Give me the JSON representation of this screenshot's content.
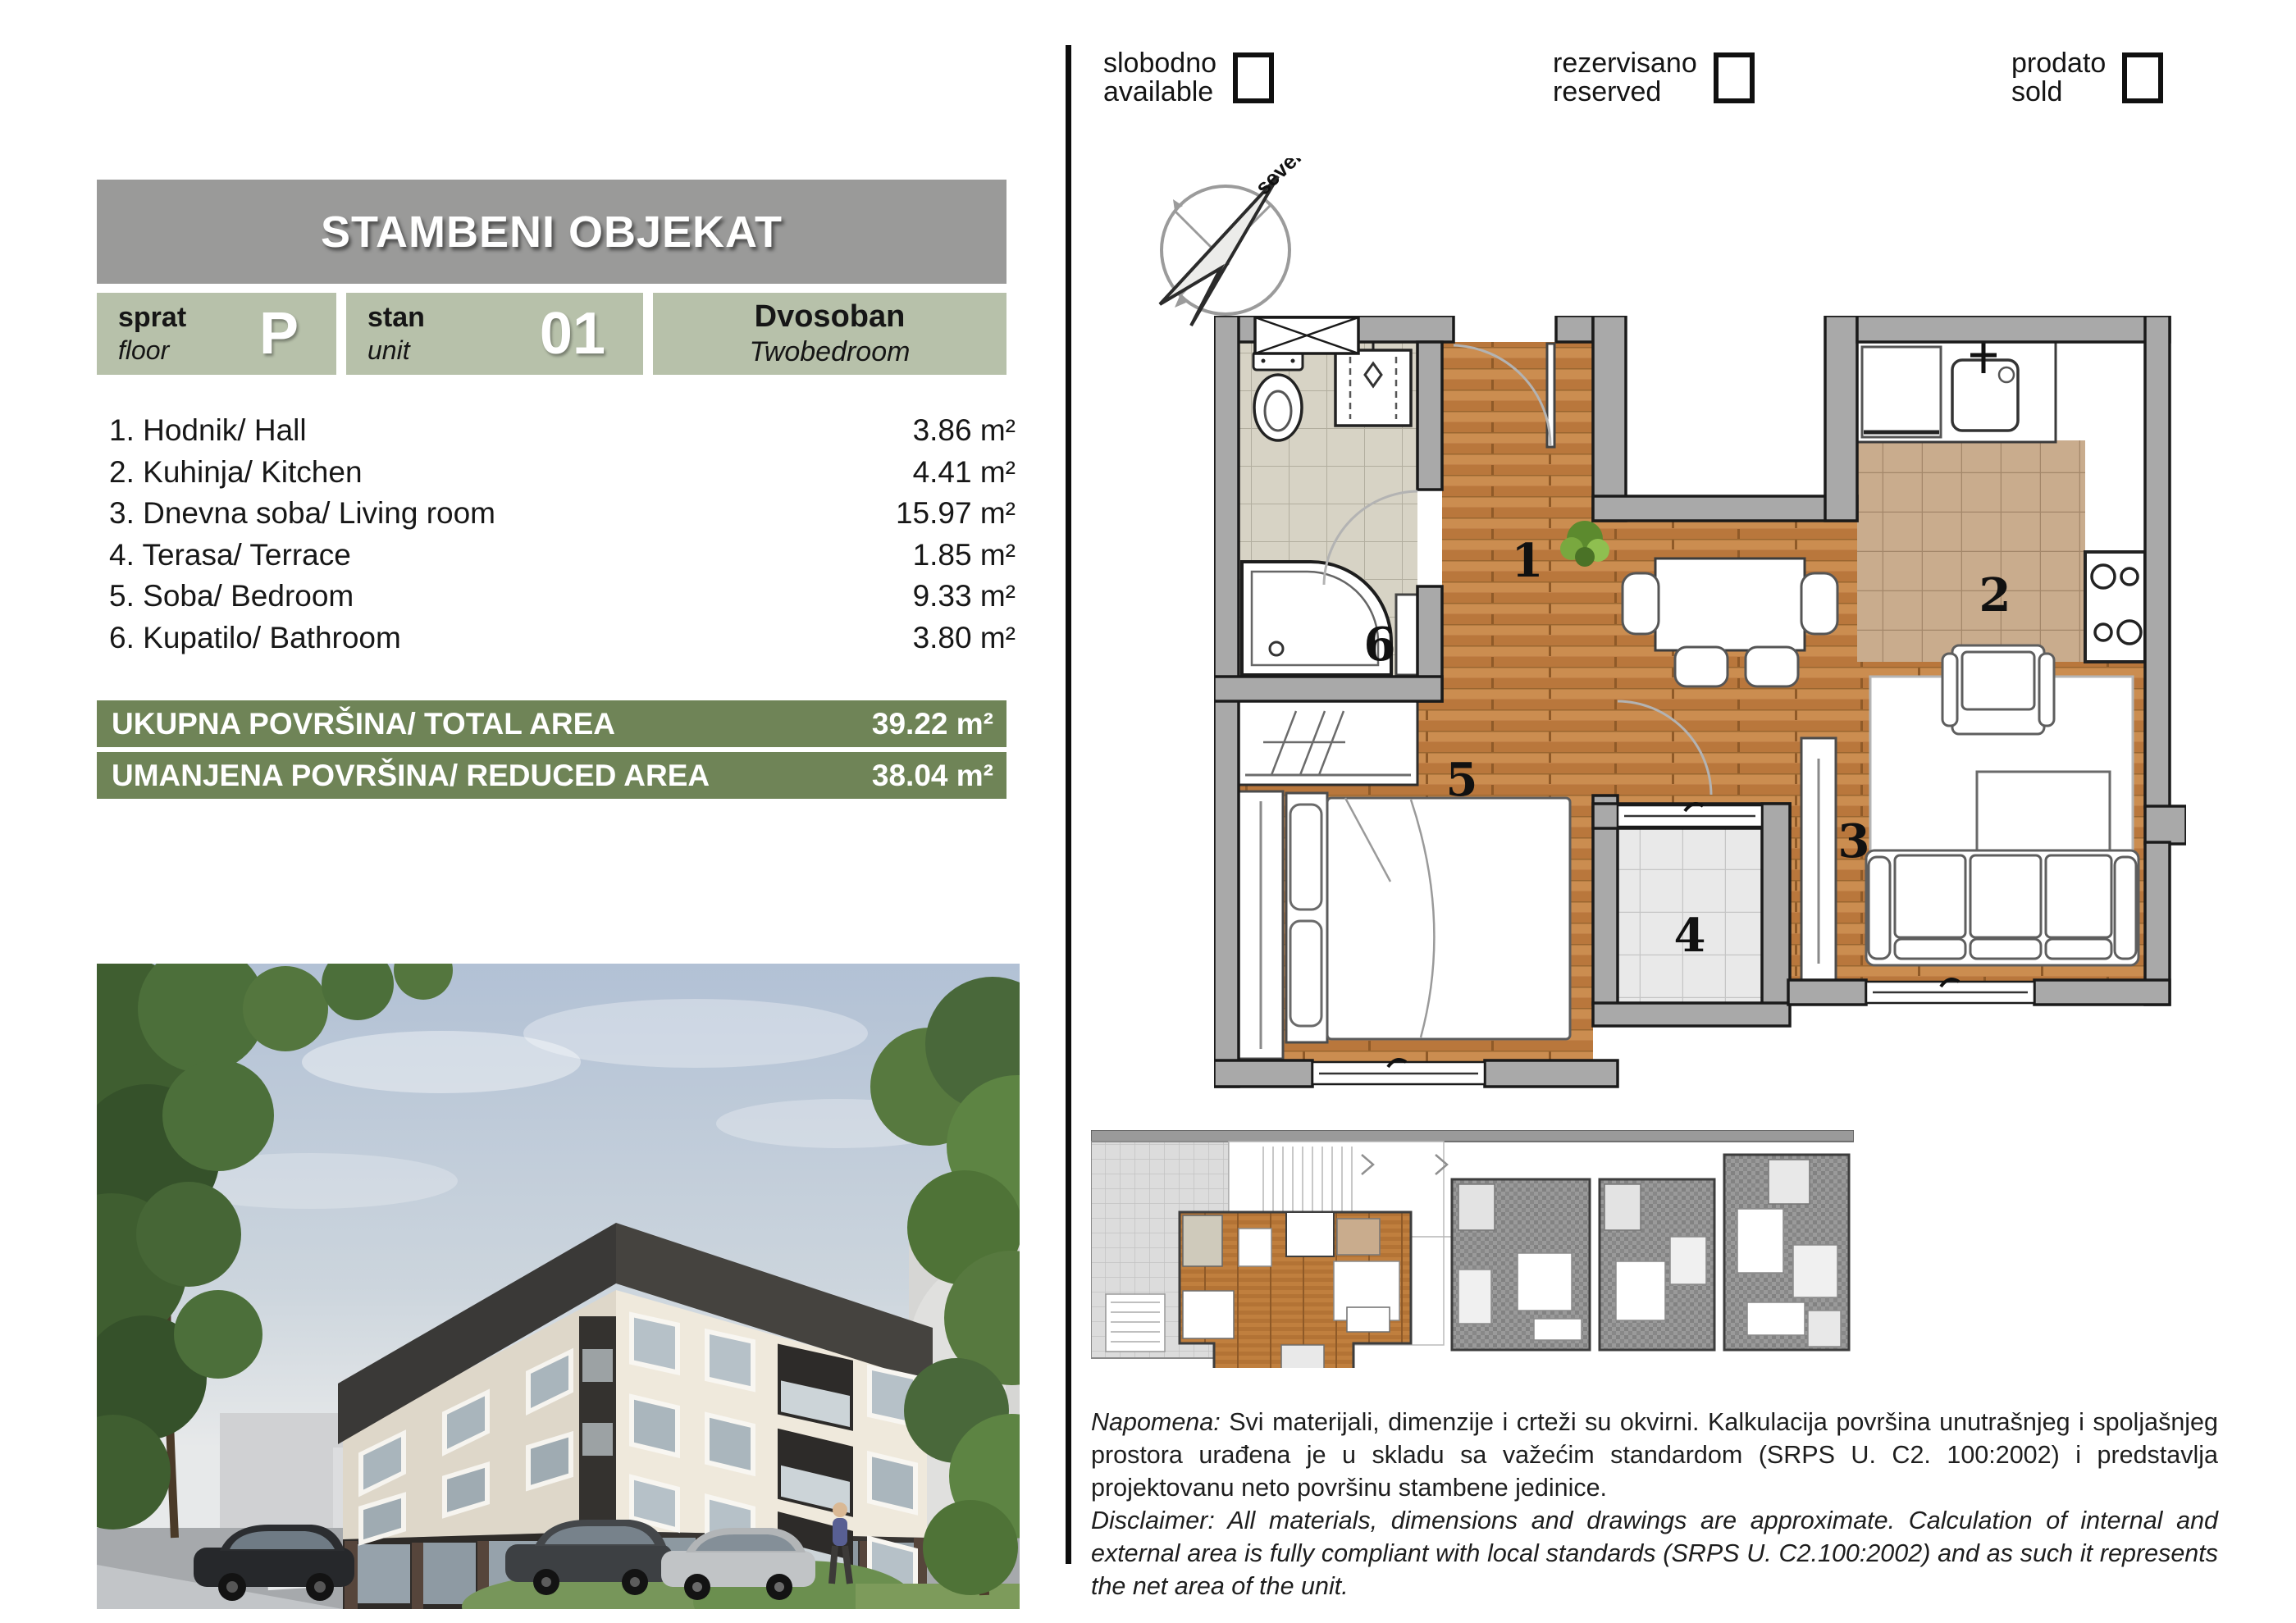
{
  "header": {
    "title": "STAMBENI OBJEKAT"
  },
  "unit_info": {
    "floor_label_sr": "sprat",
    "floor_label_en": "floor",
    "floor_value": "P",
    "unit_label_sr": "stan",
    "unit_label_en": "unit",
    "unit_value": "01",
    "type_sr": "Dvosoban",
    "type_en": "Twobedroom"
  },
  "rooms": [
    {
      "label": "1. Hodnik/ Hall",
      "area": "3.86 m²"
    },
    {
      "label": "2. Kuhinja/ Kitchen",
      "area": "4.41 m²"
    },
    {
      "label": "3. Dnevna soba/ Living room",
      "area": "15.97 m²"
    },
    {
      "label": "4. Terasa/ Terrace",
      "area": "1.85 m²"
    },
    {
      "label": "5. Soba/ Bedroom",
      "area": "9.33 m²"
    },
    {
      "label": "6. Kupatilo/ Bathroom",
      "area": "3.80 m²"
    }
  ],
  "totals": {
    "total_label": "UKUPNA POVRŠINA/ TOTAL AREA",
    "total_value": "39.22 m²",
    "reduced_label": "UMANJENA POVRŠINA/ REDUCED AREA",
    "reduced_value": "38.04 m²"
  },
  "legend": [
    {
      "sr": "slobodno",
      "en": "available"
    },
    {
      "sr": "rezervisano",
      "en": "reserved"
    },
    {
      "sr": "prodato",
      "en": "sold"
    }
  ],
  "compass": {
    "north_label": "sever"
  },
  "plan": {
    "labels": {
      "hall": "1",
      "kitchen": "2",
      "living": "3",
      "terrace": "4",
      "bedroom": "5",
      "bathroom": "6"
    }
  },
  "disclaimer": {
    "sr_prefix": "Napomena:",
    "sr_text": " Svi materijali, dimenzije i crteži su okvirni. Kalkulacija površina unutrašnjeg i spoljašnjeg prostora urađena je u skladu sa važećim standardom (SRPS U. C2. 100:2002) i predstavlja projektovanu neto površinu stambene jedinice.",
    "en_prefix": "Disclaimer:",
    "en_text": " All materials, dimensions and drawings are approximate. Calculation of internal and external area is fully compliant with local standards (SRPS U. C2.100:2002) and as such it represents the net area of the unit."
  },
  "colors": {
    "header_gray": "#9a9a99",
    "box_green": "#b7c1aa",
    "bar_green": "#6f8457",
    "wall_gray": "#a9a9a9",
    "wood": "#c28148",
    "highlight_unit": "#c07f3e"
  }
}
